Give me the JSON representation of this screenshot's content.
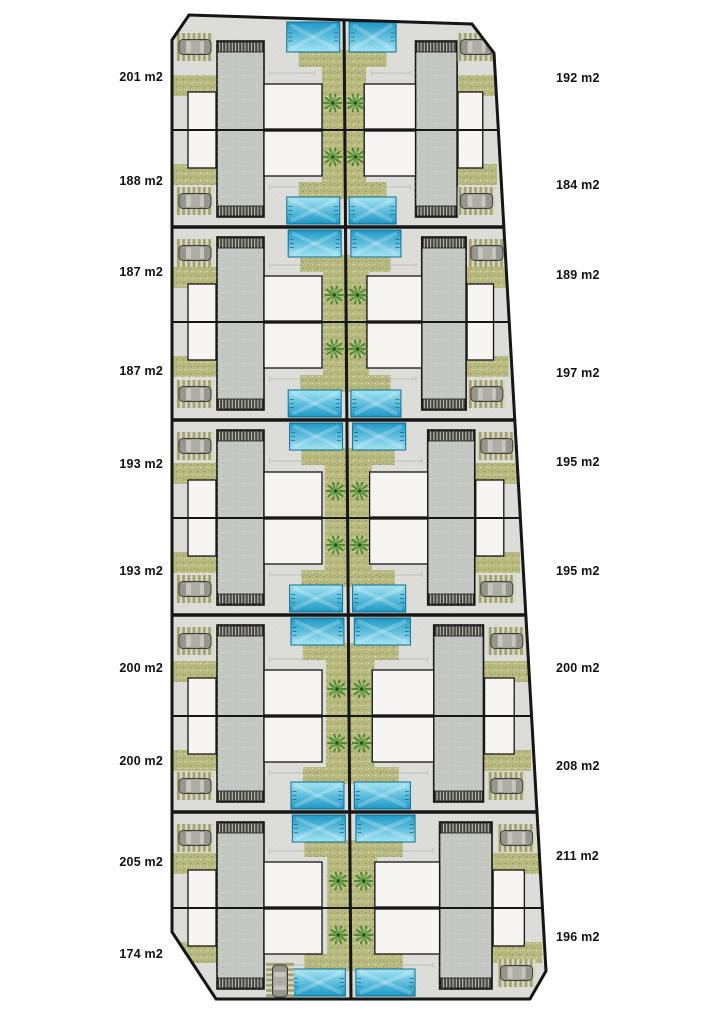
{
  "plan_labels": {
    "rows": [
      {
        "left": "201 m2",
        "right": "192 m2"
      },
      {
        "left": "188 m2",
        "right": "184 m2"
      },
      {
        "left": "187 m2",
        "right": "189 m2"
      },
      {
        "left": "187 m2",
        "right": "197 m2"
      },
      {
        "left": "193 m2",
        "right": "195 m2"
      },
      {
        "left": "193 m2",
        "right": "195 m2"
      },
      {
        "left": "200 m2",
        "right": "200 m2"
      },
      {
        "left": "200 m2",
        "right": "208 m2"
      },
      {
        "left": "205 m2",
        "right": "211 m2"
      },
      {
        "left": "174 m2",
        "right": "196 m2"
      }
    ]
  },
  "colors": {
    "background": "#ffffff",
    "pavement": "#dcdcd8",
    "outline": "#161616",
    "building_roof": "#c3c9c2",
    "building_roof_edge": "#a9b1a8",
    "stair_base": "#45453f",
    "stair_line": "#d8d8d0",
    "patio": "#f6f5f1",
    "pool_dark": "#1b98c6",
    "pool_light": "#a5e4f3",
    "pool_border": "#0d6c92",
    "garden": "#b7b97e",
    "garden_dot_dark": "#8f9156",
    "garden_dot_light": "#e0e1bd",
    "palm_dark": "#44822f",
    "palm_light": "#7cb155",
    "palm_center": "#294e1b",
    "pergola_base": "#d8d8c3",
    "pergola_stripe": "#a2a275",
    "car_body": "#96968e",
    "car_outline": "#3e3e38",
    "car_glass": "#c6c6be",
    "car_roof": "#aeaea6",
    "dimension_line": "#98988f",
    "label_color": "#111111"
  },
  "icons": {
    "palm_tree": "palm-tree-icon",
    "car": "car-icon"
  }
}
